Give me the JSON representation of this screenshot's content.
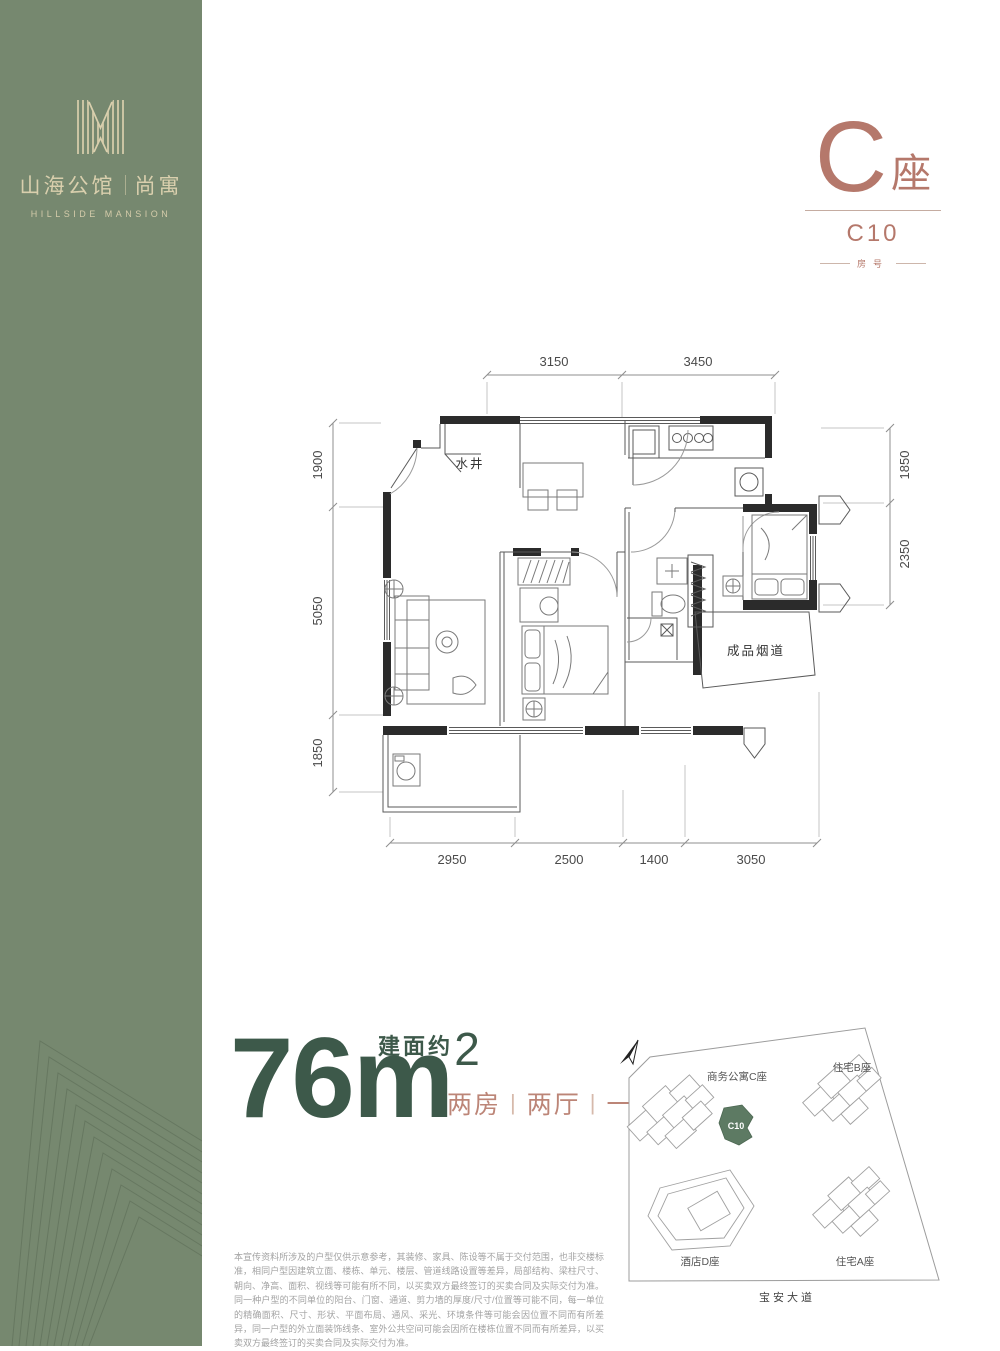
{
  "brand": {
    "cn_main": "山海公馆",
    "cn_sub": "尚寓",
    "en": "HILLSIDE MANSION"
  },
  "unit": {
    "tower": "C",
    "tower_suffix": "座",
    "number": "C10",
    "number_caption": "房号"
  },
  "floorplan": {
    "labels": {
      "water_well": "水井",
      "flue": "成品烟道"
    },
    "dims_top": [
      "3150",
      "3450"
    ],
    "dims_left": [
      "1900",
      "5050",
      "1850"
    ],
    "dims_right": [
      "1850",
      "2350"
    ],
    "dims_bottom": [
      "2950",
      "2500",
      "1400",
      "3050"
    ]
  },
  "area": {
    "prefix": "建面约",
    "value": "76",
    "unit": "m",
    "sup": "2",
    "rooms": [
      "两房",
      "两厅",
      "一卫"
    ],
    "divider": "|"
  },
  "siteplan": {
    "labels": {
      "tower_c": "商务公寓C座",
      "tower_b": "住宅B座",
      "hotel_d": "酒店D座",
      "tower_a": "住宅A座",
      "road": "宝安大道",
      "highlight": "C10"
    }
  },
  "disclaimer": "本宣传资料所涉及的户型仅供示意参考，其装修、家具、陈设等不属于交付范围，也非交楼标准，相同户型因建筑立面、楼栋、单元、楼层、管道线路设置等差异，局部结构、梁柱尺寸、朝向、净高、面积、视线等可能有所不同，以买卖双方最终签订的买卖合同及实际交付为准。同一种户型的不同单位的阳台、门窗、通道、剪力墙的厚度/尺寸/位置等可能不同，每一单位的精确面积、尺寸、形状、平面布局、通风、采光、环境条件等可能会因位置不同而有所差异，同一户型的外立面装饰线条、室外公共空间可能会因所在楼栋位置不同而有所差异，以买卖双方最终签订的买卖合同及实际交付为准。",
  "colors": {
    "band_green": "#76886f",
    "accent_terracotta": "#b5786b",
    "deep_green": "#3d594a",
    "highlight_green": "#5d7a63",
    "cream": "#d9cfad"
  }
}
